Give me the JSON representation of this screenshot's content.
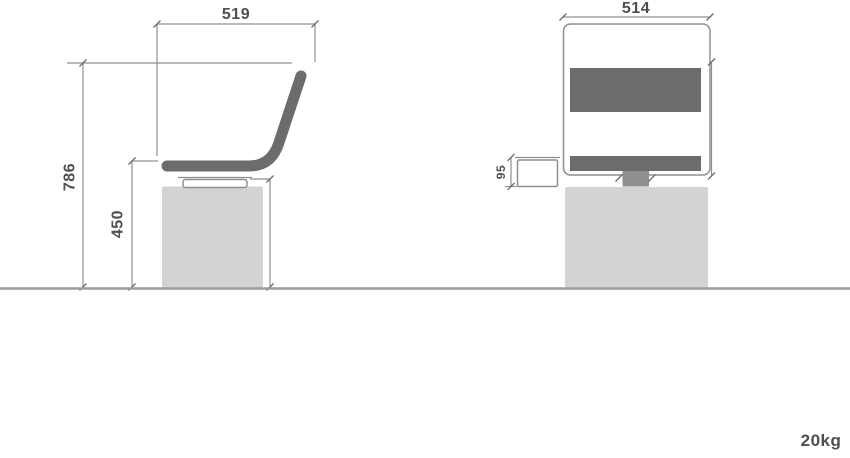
{
  "drawing": {
    "title": "chair dimension drawing",
    "side_view": {
      "depth_label": "519",
      "overall_height_label": "786",
      "seat_height_label": "450"
    },
    "front_view": {
      "width_label": "514",
      "bracket_height_label": "95"
    },
    "weight_label": "20kg",
    "colors": {
      "upholstery_dark": "#6c6c6c",
      "stem_gray": "#8f8f8f",
      "base_light": "#d3d3d3",
      "line_gray": "#8f8f8f",
      "text_gray": "#4f4f4f"
    }
  }
}
